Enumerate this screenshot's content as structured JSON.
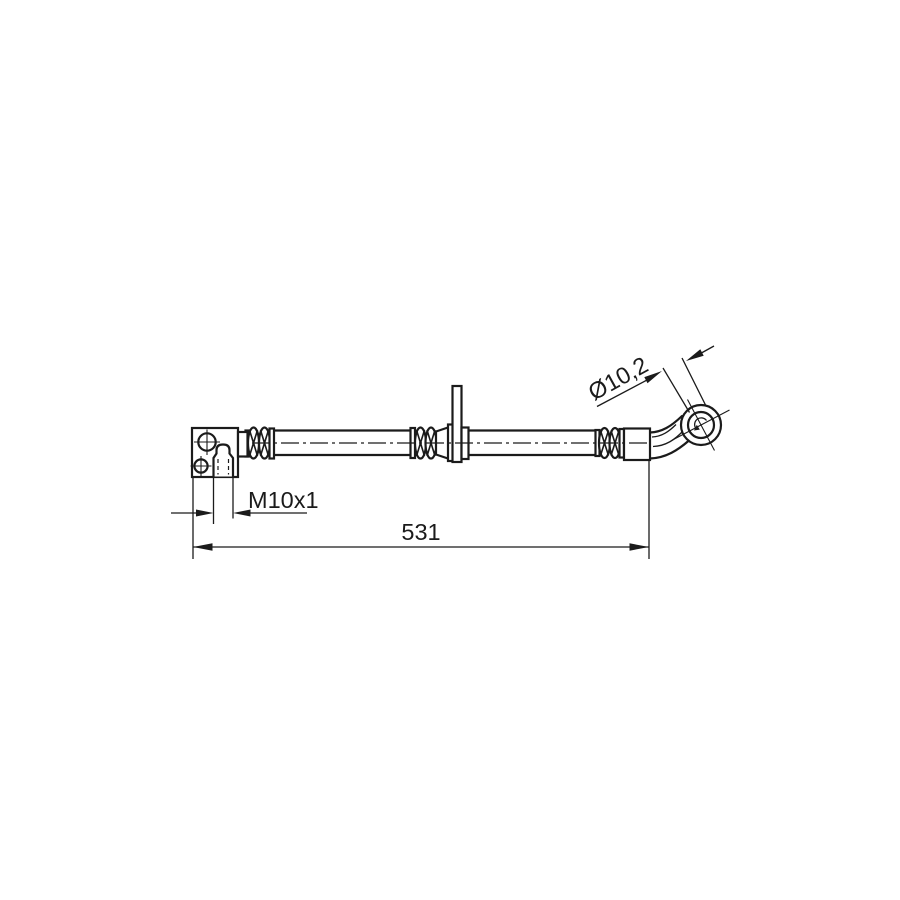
{
  "canvas": {
    "background_color": "#ffffff",
    "line_color": "#1b1b1b"
  },
  "drawing": {
    "kind": "brake-hose-technical-drawing",
    "labels": {
      "bore_diameter": "Ø10,2",
      "thread_size": "M10x1",
      "overall_length": "531"
    }
  }
}
